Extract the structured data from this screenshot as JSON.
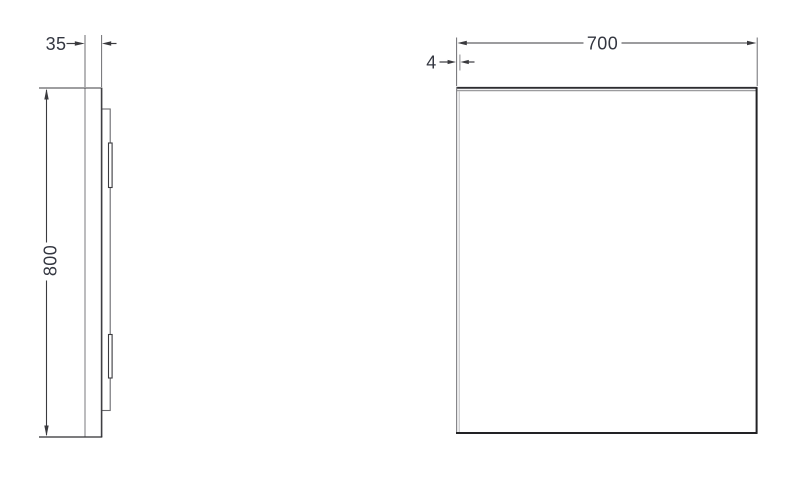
{
  "drawing": {
    "type": "technical-dimension-drawing",
    "side_view": {
      "depth_label": "35",
      "height_label": "800"
    },
    "front_view": {
      "width_label": "700",
      "edge_label": "4"
    }
  },
  "colors": {
    "background": "#ffffff",
    "line_dark": "#2d2d30",
    "line_medium": "#58585c",
    "line_light": "#9b9b9e",
    "dimension_text": "#343741"
  }
}
